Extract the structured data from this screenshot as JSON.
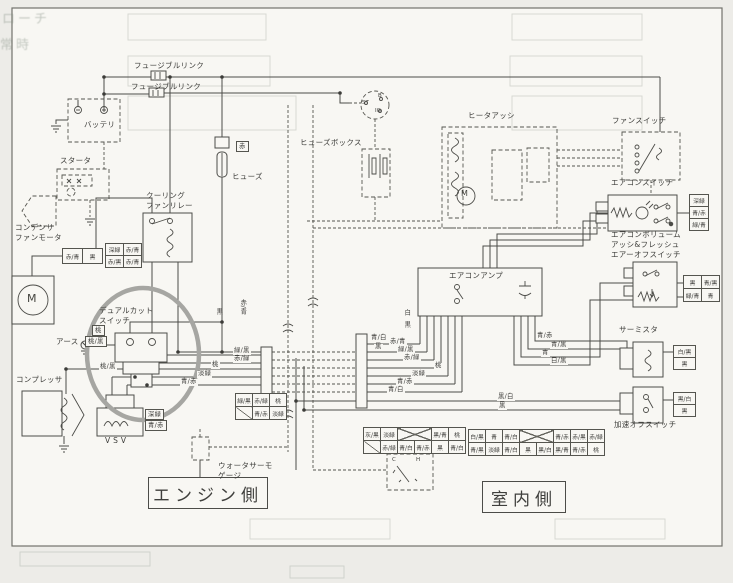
{
  "side_labels": {
    "engine": "エンジン側",
    "interior": "室内側"
  },
  "texts": [
    {
      "n": "fusible-link-1-label",
      "t": "フュージブルリンク",
      "x": 134,
      "y": 61,
      "c": "comp"
    },
    {
      "n": "fusible-link-2-label",
      "t": "フュージブルリンク",
      "x": 131,
      "y": 82,
      "c": "comp"
    },
    {
      "n": "battery-label",
      "t": "バッテリ",
      "x": 84,
      "y": 120,
      "c": "comp"
    },
    {
      "n": "starter-label",
      "t": "スタータ",
      "x": 60,
      "y": 156,
      "c": "comp"
    },
    {
      "n": "fuse-label",
      "t": "ヒューズ",
      "x": 232,
      "y": 172,
      "c": "comp"
    },
    {
      "n": "cooling-fan-relay-label",
      "t": "クーリング\nファンリレー",
      "x": 146,
      "y": 191,
      "c": "comp"
    },
    {
      "n": "condenser-fan-motor-label",
      "t": "コンデンサ\nファンモータ",
      "x": 15,
      "y": 223,
      "c": "comp"
    },
    {
      "n": "dual-cut-switch-label",
      "t": "デュアルカット\nスイッチ",
      "x": 99,
      "y": 306,
      "c": "comp"
    },
    {
      "n": "earth-label",
      "t": "アース",
      "x": 56,
      "y": 337,
      "c": "comp"
    },
    {
      "n": "compressor-label",
      "t": "コンプレッサ",
      "x": 16,
      "y": 375,
      "c": "comp"
    },
    {
      "n": "vsv-label",
      "t": "V S V",
      "x": 105,
      "y": 436,
      "c": "comp"
    },
    {
      "n": "water-thermo-gauge-label",
      "t": "ウォータサーモ\nゲージ",
      "x": 218,
      "y": 461,
      "c": "comp"
    },
    {
      "n": "fuse-box-label",
      "t": "ヒューズボックス",
      "x": 300,
      "y": 138,
      "c": "comp"
    },
    {
      "n": "heater-assy-label",
      "t": "ヒータアッシ",
      "x": 468,
      "y": 111,
      "c": "comp"
    },
    {
      "n": "fan-switch-label",
      "t": "ファンスイッチ",
      "x": 612,
      "y": 116,
      "c": "comp"
    },
    {
      "n": "ac-switch-label",
      "t": "エアコンスイッチ",
      "x": 611,
      "y": 178,
      "c": "comp"
    },
    {
      "n": "ac-volume-switch-label",
      "t": "エアコンボリューム\nアッシ&フレッシュ\nエアーオフスイッチ",
      "x": 611,
      "y": 230,
      "c": "comp"
    },
    {
      "n": "thermistor-label",
      "t": "サーミスタ",
      "x": 619,
      "y": 325,
      "c": "comp"
    },
    {
      "n": "accel-off-switch-label",
      "t": "加速オフスイッチ",
      "x": 614,
      "y": 420,
      "c": "comp"
    },
    {
      "n": "ac-amp-label",
      "t": "エアコンアンプ",
      "x": 449,
      "y": 271,
      "c": "comp"
    },
    {
      "t": "桃/黒",
      "x": 99,
      "y": 364,
      "c": "wire"
    },
    {
      "t": "緑/黒",
      "x": 233,
      "y": 348,
      "c": "wire"
    },
    {
      "t": "赤/緑",
      "x": 233,
      "y": 356,
      "c": "wire"
    },
    {
      "t": "桃",
      "x": 211,
      "y": 362,
      "c": "wire"
    },
    {
      "t": "淡緑",
      "x": 197,
      "y": 371,
      "c": "wire"
    },
    {
      "t": "青/赤",
      "x": 180,
      "y": 379,
      "c": "wire"
    },
    {
      "t": "青/白",
      "x": 370,
      "y": 335,
      "c": "wire"
    },
    {
      "t": "黒",
      "x": 374,
      "y": 344,
      "c": "wire"
    },
    {
      "t": "赤/青",
      "x": 389,
      "y": 339,
      "c": "wire"
    },
    {
      "t": "緑/黒",
      "x": 397,
      "y": 347,
      "c": "wire"
    },
    {
      "t": "赤/緑",
      "x": 403,
      "y": 355,
      "c": "wire"
    },
    {
      "t": "桃",
      "x": 434,
      "y": 363,
      "c": "wire"
    },
    {
      "t": "淡緑",
      "x": 411,
      "y": 371,
      "c": "wire"
    },
    {
      "t": "青/赤",
      "x": 396,
      "y": 379,
      "c": "wire"
    },
    {
      "t": "青/白",
      "x": 387,
      "y": 387,
      "c": "wire"
    },
    {
      "t": "青/赤",
      "x": 536,
      "y": 333,
      "c": "wire"
    },
    {
      "t": "青/黒",
      "x": 550,
      "y": 342,
      "c": "wire"
    },
    {
      "t": "青",
      "x": 541,
      "y": 350,
      "c": "wire"
    },
    {
      "t": "白/黒",
      "x": 550,
      "y": 358,
      "c": "wire"
    },
    {
      "t": "黒/白",
      "x": 497,
      "y": 394,
      "c": "wire"
    },
    {
      "t": "黒",
      "x": 498,
      "y": 403,
      "c": "wire"
    },
    {
      "t": "白",
      "x": 403,
      "y": 309,
      "c": "vert"
    },
    {
      "t": "黒",
      "x": 403,
      "y": 321,
      "c": "vert"
    },
    {
      "t": "黒",
      "x": 215,
      "y": 308,
      "c": "vert"
    },
    {
      "t": "赤/青",
      "x": 239,
      "y": 299,
      "c": "vert"
    },
    {
      "t": "赤",
      "x": 236,
      "y": 141,
      "c": "wbox"
    },
    {
      "t": "桃",
      "x": 92,
      "y": 325,
      "c": "wbox"
    },
    {
      "t": "桃/黒",
      "x": 85,
      "y": 336,
      "c": "wbox"
    },
    {
      "t": "深緑",
      "x": 145,
      "y": 409,
      "c": "wbox"
    },
    {
      "t": "青/赤",
      "x": 145,
      "y": 420,
      "c": "wbox"
    },
    {
      "n": "ignition-terminal-b",
      "t": "B",
      "x": 378,
      "y": 93,
      "c": "tiny"
    },
    {
      "n": "ignition-terminal-st",
      "t": "ST",
      "x": 362,
      "y": 100,
      "c": "tiny"
    },
    {
      "n": "ignition-terminal-ig",
      "t": "IG",
      "x": 375,
      "y": 108,
      "c": "tiny"
    },
    {
      "n": "gauge-cold-mark",
      "t": "C",
      "x": 392,
      "y": 457,
      "c": "tiny"
    },
    {
      "n": "gauge-hot-mark",
      "t": "H",
      "x": 416,
      "y": 457,
      "c": "tiny"
    },
    {
      "n": "condenser-motor-m",
      "t": "M",
      "x": 27,
      "y": 292,
      "c": "mlg"
    },
    {
      "n": "blower-motor-m",
      "t": "M",
      "x": 461,
      "y": 189,
      "c": "msm"
    },
    {
      "n": "bleed-through-text",
      "t": "ローチ",
      "x": 2,
      "y": 12,
      "c": "ghost"
    },
    {
      "n": "bleed-through-text",
      "t": "常時",
      "x": 0,
      "y": 38,
      "c": "ghost"
    }
  ],
  "connector_tables": [
    {
      "n": "cooling-fan-relay-connector",
      "x": 105,
      "y": 243,
      "cw": 17,
      "ch": 11,
      "rows": [
        [
          "深緑",
          "赤/青"
        ],
        [
          "赤/黒",
          "赤/青"
        ]
      ]
    },
    {
      "n": "condenser-fan-motor-connector",
      "x": 62,
      "y": 248,
      "cw": 19,
      "ch": 14,
      "rows": [
        [
          "赤/青",
          "黒"
        ]
      ]
    },
    {
      "n": "left-harness-connector-table",
      "x": 235,
      "y": 393,
      "cw": 16,
      "ch": 12,
      "rows": [
        [
          "緑/黒",
          "赤/緑",
          "桃"
        ],
        [
          "DG",
          "青/赤",
          "淡緑"
        ]
      ]
    },
    {
      "n": "bottom-left-connector-table",
      "x": 363,
      "y": 427,
      "cw": 16,
      "ch": 12,
      "rows": [
        [
          "灰/黒",
          "淡緑",
          "XX",
          "黒/青",
          "桃"
        ],
        [
          "DG",
          "赤/緑",
          "青/白",
          "青/赤",
          "黒",
          "青/白"
        ]
      ]
    },
    {
      "n": "bottom-right-connector-table",
      "x": 468,
      "y": 429,
      "cw": 16,
      "ch": 12,
      "rows": [
        [
          "白/黒",
          "青",
          "青/白",
          "XX",
          "青/赤",
          "赤/黒",
          "赤/緑"
        ],
        [
          "青/黒",
          "淡緑",
          "青/白",
          "黒",
          "黒/白",
          "黒/青",
          "青/赤",
          "桃"
        ]
      ]
    },
    {
      "n": "ac-switch-connector",
      "x": 689,
      "y": 194,
      "cw": 18,
      "ch": 11,
      "rows": [
        [
          "深緑"
        ],
        [
          "青/赤"
        ],
        [
          "緑/青"
        ]
      ]
    },
    {
      "n": "ac-volume-connector",
      "x": 683,
      "y": 275,
      "cw": 17,
      "ch": 12,
      "rows": [
        [
          "黒",
          "青/黒"
        ],
        [
          "緑/青",
          "青"
        ]
      ]
    },
    {
      "n": "thermistor-connector",
      "x": 673,
      "y": 345,
      "cw": 21,
      "ch": 11,
      "rows": [
        [
          "白/黒"
        ],
        [
          "黒"
        ]
      ]
    },
    {
      "n": "accel-off-switch-connector",
      "x": 673,
      "y": 392,
      "cw": 21,
      "ch": 11,
      "rows": [
        [
          "黒/白"
        ],
        [
          "黒"
        ]
      ]
    }
  ]
}
